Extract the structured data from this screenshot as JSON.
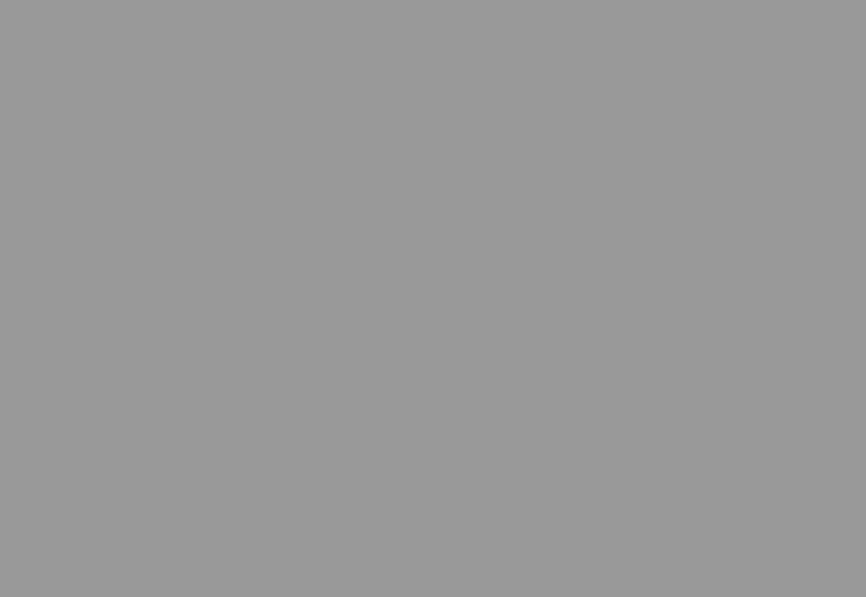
{
  "screen": {
    "background_color": "#999999"
  }
}
